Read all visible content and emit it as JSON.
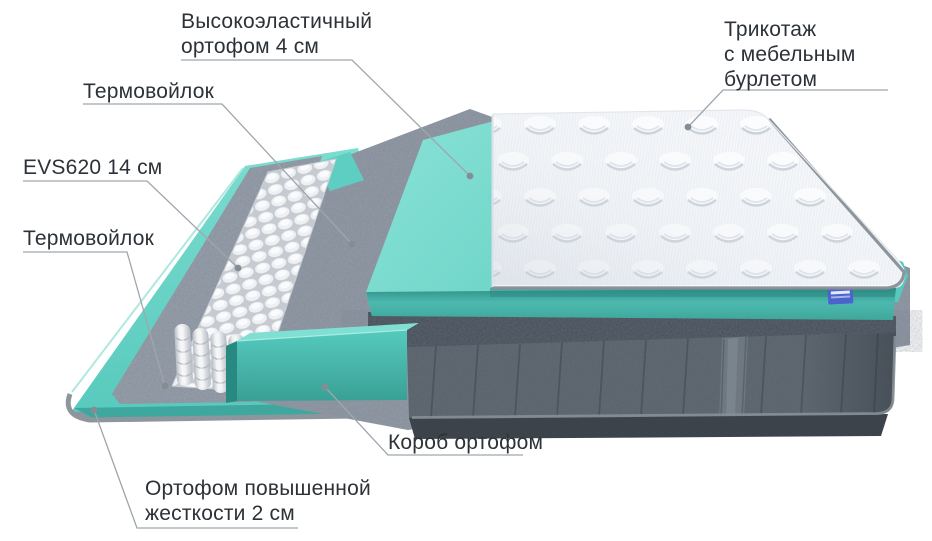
{
  "callouts": {
    "ortofom4": {
      "lines": [
        "Высокоэластичный",
        "ортофом 4 см"
      ]
    },
    "termo_top": {
      "lines": [
        "Термовойлок"
      ]
    },
    "evs": {
      "lines": [
        "EVS620 14 см"
      ]
    },
    "termo_bottom": {
      "lines": [
        "Термовойлок"
      ]
    },
    "trikotazh": {
      "lines": [
        "Трикотаж",
        "с мебельным",
        "бурлетом"
      ]
    },
    "korob": {
      "lines": [
        "Короб ортофом"
      ]
    },
    "ortofom2": {
      "lines": [
        "Ортофом повышенной",
        "жесткости 2 см"
      ]
    }
  },
  "colors": {
    "text": "#2c3238",
    "leader_line": "#9fa6ac",
    "leader_dot": "#858d94",
    "accent_teal": "#5ecfc3",
    "teal_dark": "#2e9a90",
    "felt_gray": "#98a0ac",
    "felt_dark": "#454e58",
    "velvet_gray": "#5a626b",
    "quilt_white": "#f4f6f9",
    "piping_gray": "#8a9199",
    "springs_white": "#eef0f3",
    "brand_tag_blue": "#4a63cd"
  }
}
